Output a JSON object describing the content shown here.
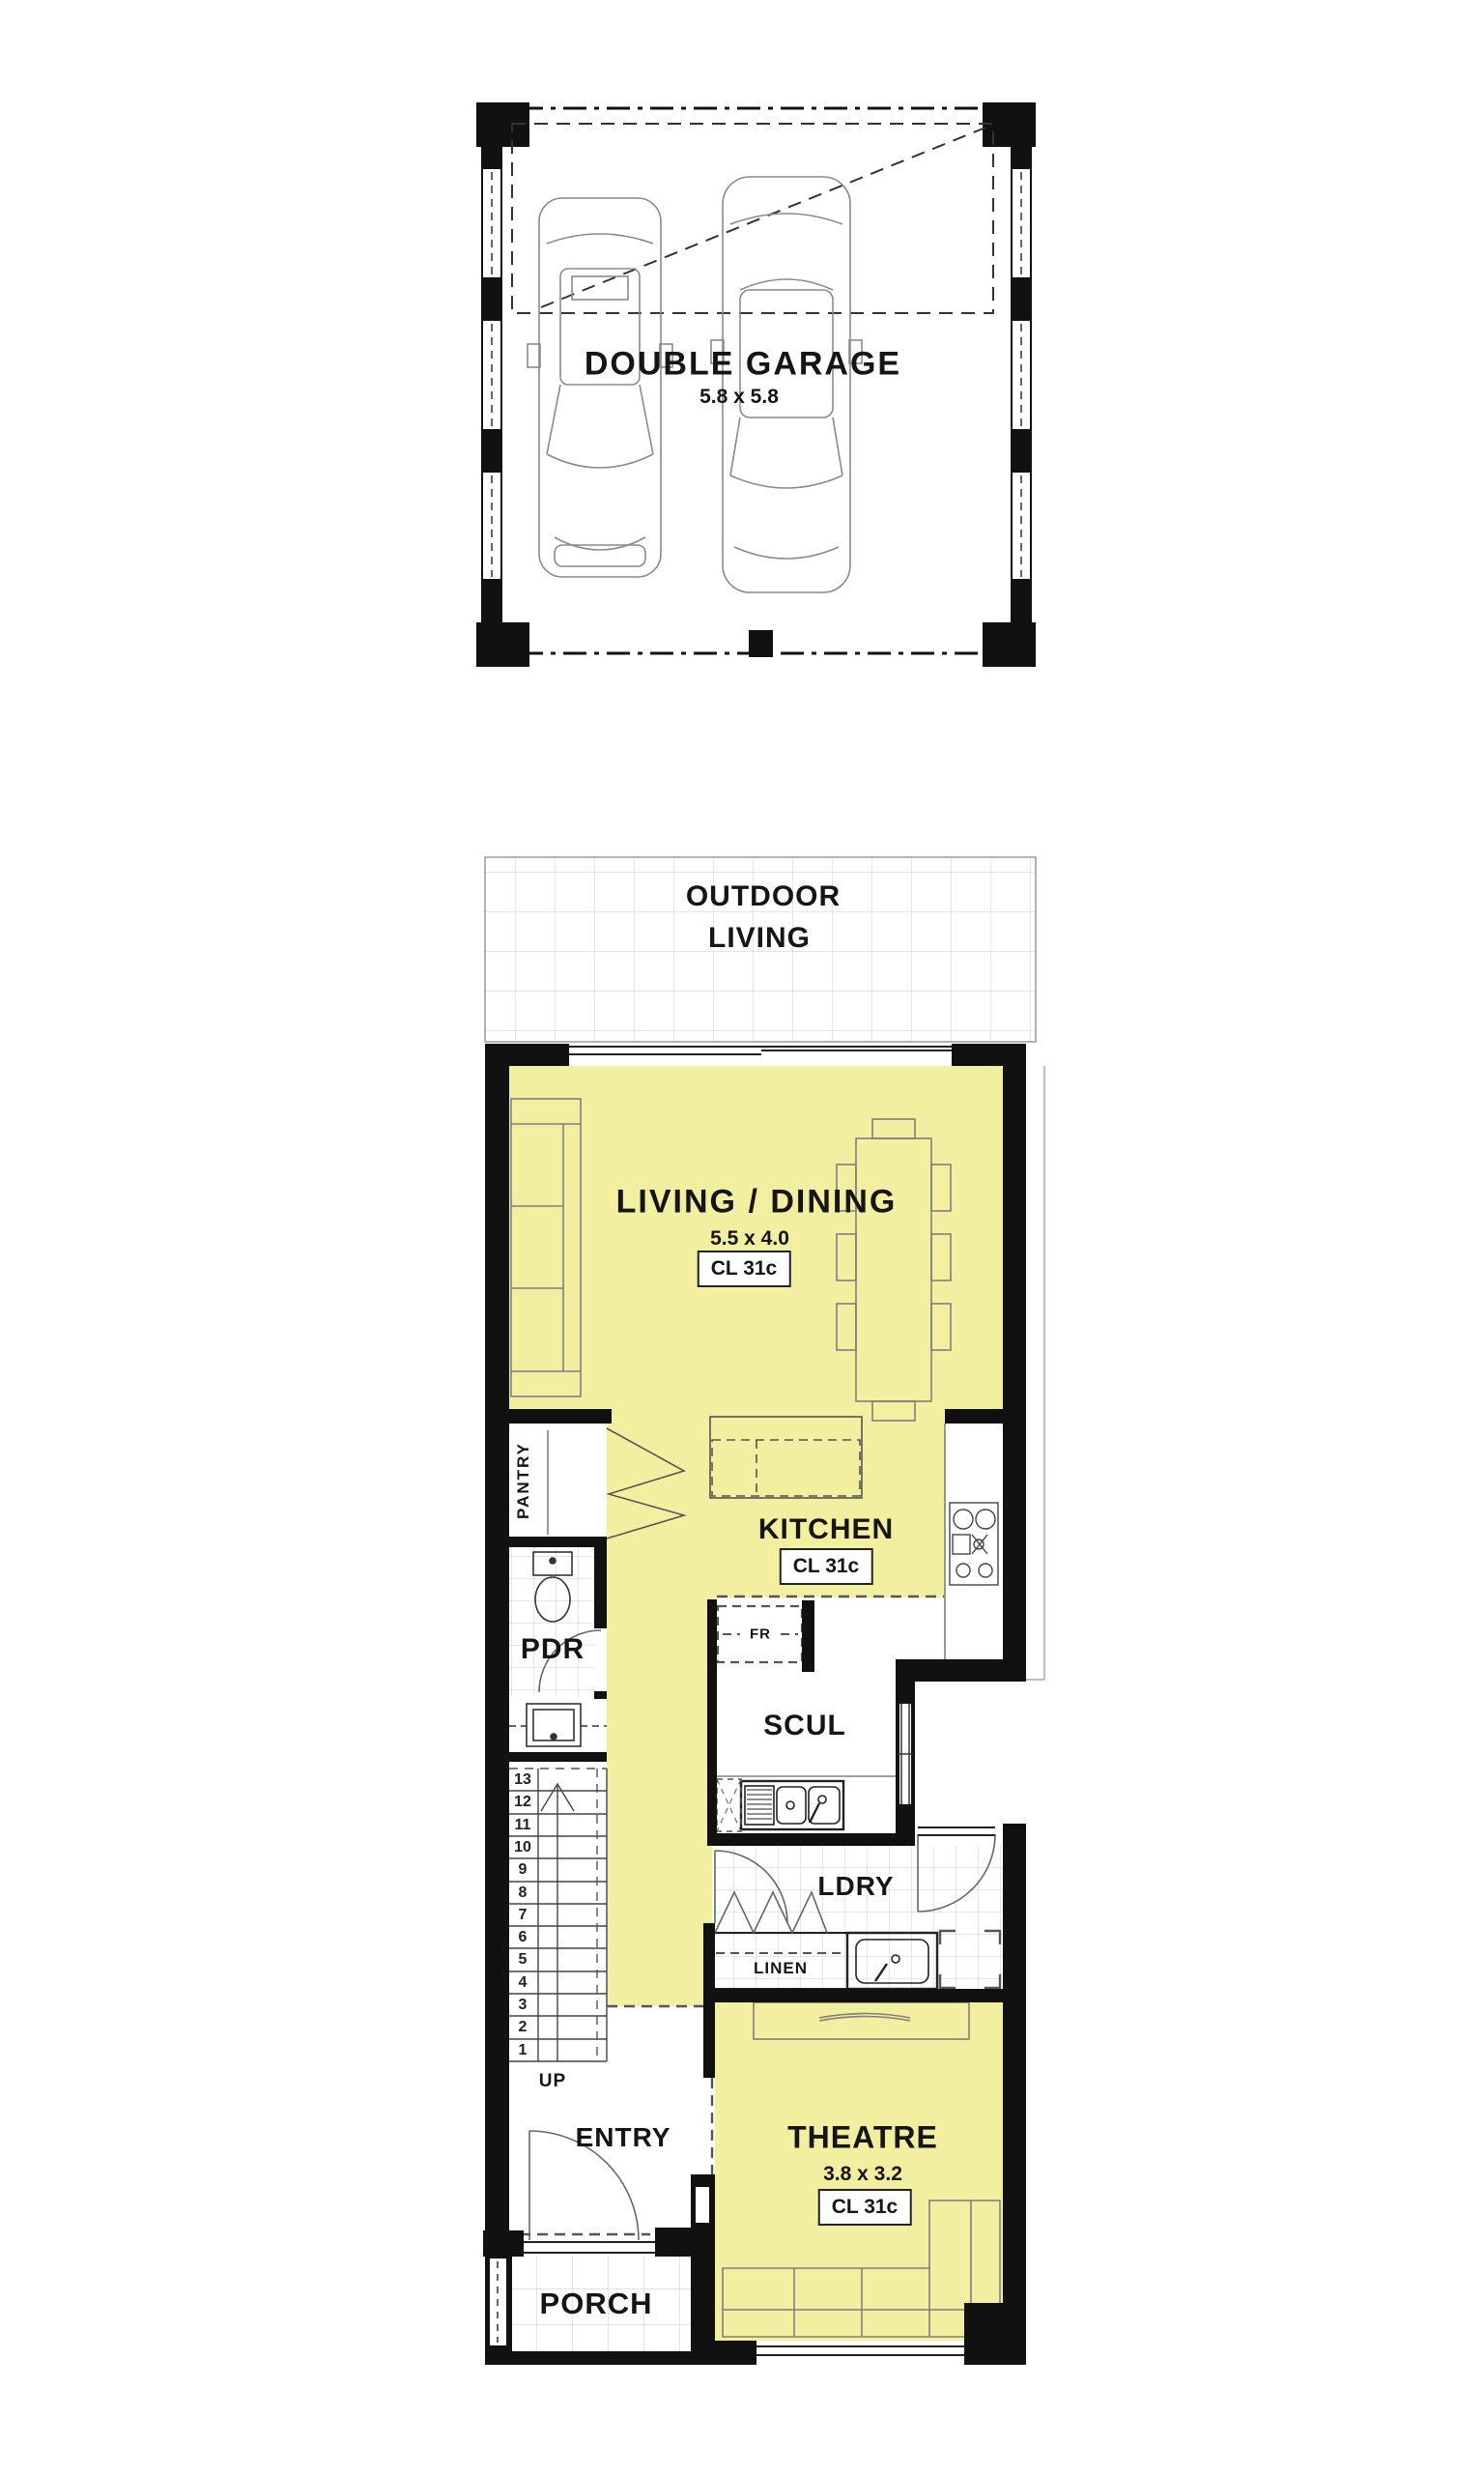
{
  "colors": {
    "floor_yellow": "#F3EFA0",
    "wall_black": "#111111",
    "tile_line": "#CCCCCC",
    "furniture_line": "#7F7F7F",
    "boundary_dash": "#555555"
  },
  "rooms": {
    "garage": {
      "name": "DOUBLE GARAGE",
      "dim": "5.8 x 5.8"
    },
    "outdoor_living": {
      "name_line1": "OUTDOOR",
      "name_line2": "LIVING"
    },
    "living_dining": {
      "name": "LIVING / DINING",
      "dim": "5.5 x 4.0",
      "ceiling": "CL 31c"
    },
    "kitchen": {
      "name": "KITCHEN",
      "ceiling": "CL 31c"
    },
    "pantry": {
      "name": "PANTRY"
    },
    "pdr": {
      "name": "PDR"
    },
    "scullery": {
      "name": "SCUL"
    },
    "fridge": {
      "name": "FR"
    },
    "laundry": {
      "name": "LDRY"
    },
    "linen": {
      "name": "LINEN"
    },
    "entry": {
      "name": "ENTRY"
    },
    "porch": {
      "name": "PORCH"
    },
    "theatre": {
      "name": "THEATRE",
      "dim": "3.8 x 3.2",
      "ceiling": "CL 31c"
    },
    "stairs": {
      "up_label": "UP",
      "treads": [
        "13",
        "12",
        "11",
        "10",
        "9",
        "8",
        "7",
        "6",
        "5",
        "4",
        "3",
        "2",
        "1"
      ]
    }
  }
}
